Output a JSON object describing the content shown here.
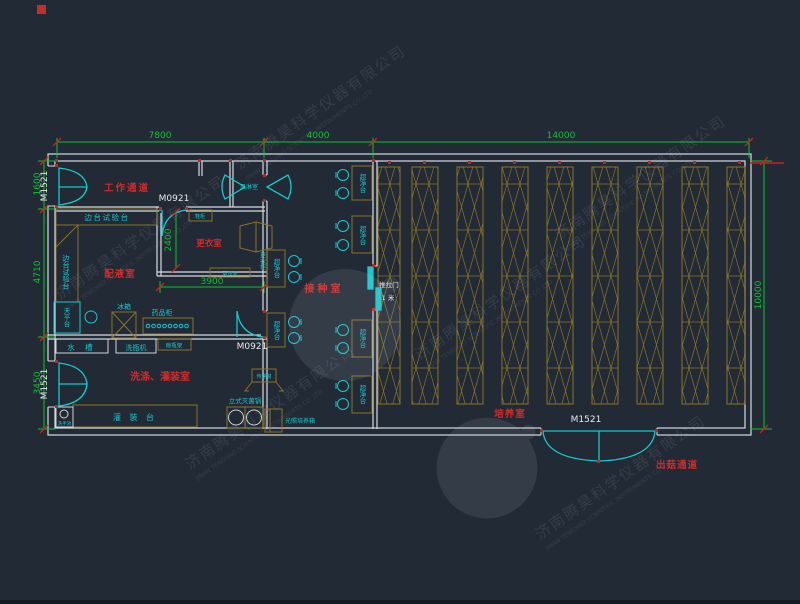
{
  "watermark": {
    "company_cn": "济南腾昊科学仪器有限公司",
    "company_en": "JINAN TENGHAO SCIENTIFIC INSTRUMENTS CO.,LTD"
  },
  "dimensions": {
    "top_left_span": "7800",
    "top_mid_span": "4000",
    "top_right_span": "14000",
    "left_top": "1600",
    "left_mid": "4710",
    "left_bottom": "3450",
    "right_full": "10000",
    "changing_depth": "2400",
    "changing_width": "3900"
  },
  "rooms": {
    "work_corridor": "工作通道",
    "air_shower": "风淋室",
    "preparation_room": "配液室",
    "changing_room": "更衣室",
    "inoculation_room": "接种室",
    "washing_filling_room": "洗涤、灌装室",
    "cultivation_room": "培养室",
    "harvest_corridor": "出菇通道"
  },
  "doors": {
    "double_door_code": "M1521",
    "single_door_code": "M0921",
    "sliding_door": "推拉门",
    "sliding_door_width": "1 米"
  },
  "fixtures": {
    "side_test_bench": "边台试验台",
    "balance_table": "天平台",
    "fridge": "冰箱",
    "medicine_cabinet": "药品柜",
    "shoe_cabinet": "鞋柜",
    "wardrobe": "更衣柜",
    "changing_bench": "更衣凳",
    "clean_bench": "超净台",
    "sink": "水 槽",
    "bottle_washer": "洗瓶机",
    "bottle_drying_rack": "晾瓶架",
    "hand_basin": "洗手池",
    "filling_bench": "灌 装 台",
    "vertical_sterilizer": "立式灭菌锅",
    "pass_window": "传递窗",
    "light_incubator": "光照培养箱"
  }
}
